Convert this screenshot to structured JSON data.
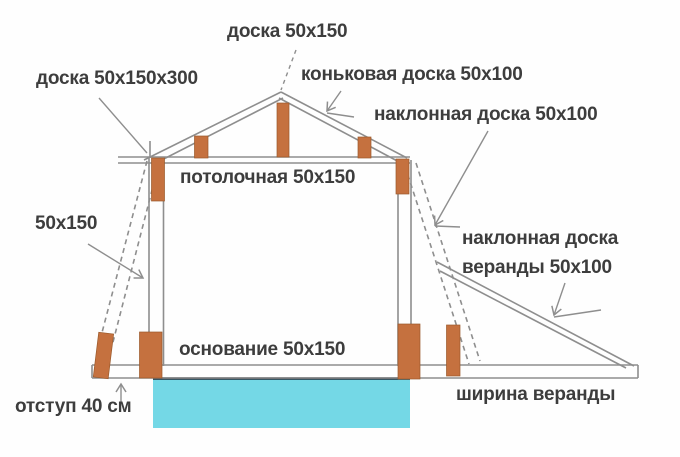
{
  "diagram": {
    "labels": {
      "board_top": "доска 50x150",
      "board_left": "доска 50x150x300",
      "ridge_board": "коньковая доска 50x100",
      "inclined_board": "наклонная доска 50x100",
      "ceiling_board": "потолочная 50x150",
      "side_board": "50x150",
      "veranda_board_line1": "наклонная доска",
      "veranda_board_line2": "веранды 50x100",
      "base_board": "основание 50x150",
      "offset": "отступ 40 см",
      "veranda_width": "ширина веранды"
    },
    "colors": {
      "line": "#8e8e8e",
      "text": "#3d3d3d",
      "post": "#c5713f",
      "foundation": "#74d8e6",
      "foundation_edge": "#1f2a38",
      "background": "#fefefe"
    }
  }
}
